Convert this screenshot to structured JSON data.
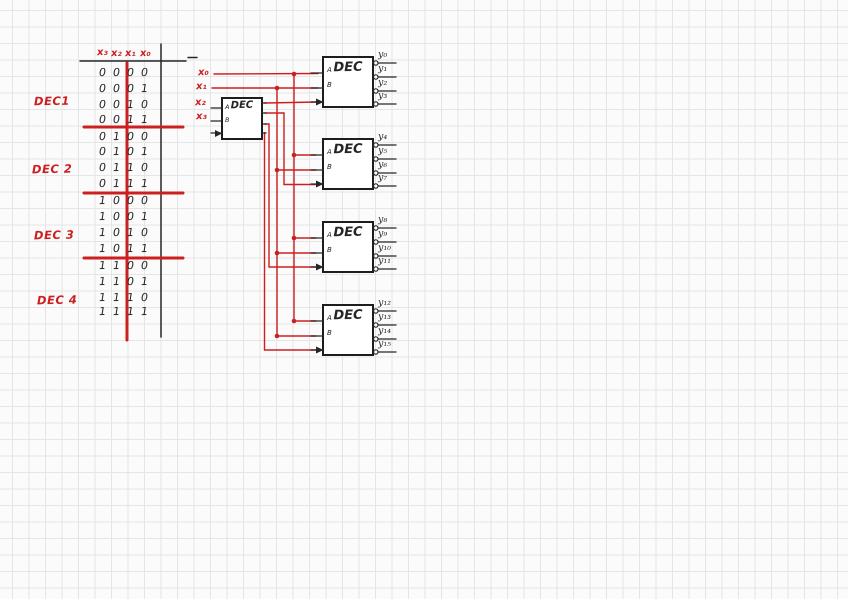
{
  "truth_table": {
    "headers": [
      "x₃",
      "x₂",
      "x₁",
      "x₀"
    ],
    "rows": [
      "0000",
      "0001",
      "0010",
      "0011",
      "0100",
      "0101",
      "0110",
      "0111",
      "1000",
      "1001",
      "1010",
      "1011",
      "1100",
      "1101",
      "1110",
      "1111"
    ],
    "group_labels": [
      "DEC1",
      "DEC 2",
      "DEC 3",
      "DEC 4"
    ]
  },
  "schematic": {
    "input_labels": [
      "x₀",
      "x₁",
      "x₂",
      "x₃"
    ],
    "pin_labels": [
      "A",
      "B"
    ],
    "predecoder": {
      "label": "DEC"
    },
    "decoders": [
      {
        "label": "DEC",
        "outputs": [
          "y₀",
          "y₁",
          "y₂",
          "y₃"
        ]
      },
      {
        "label": "DEC",
        "outputs": [
          "y₄",
          "y₅",
          "y₆",
          "y₇"
        ]
      },
      {
        "label": "DEC",
        "outputs": [
          "y₈",
          "y₉",
          "y₁₀",
          "y₁₁"
        ]
      },
      {
        "label": "DEC",
        "outputs": [
          "y₁₂",
          "y₁₃",
          "y₁₄",
          "y₁₅"
        ]
      }
    ]
  },
  "colors": {
    "ink_red": "#cd1f1f",
    "ink_black": "#262626",
    "paper": "#fbfbfb",
    "grid": "#e5e5e5"
  }
}
